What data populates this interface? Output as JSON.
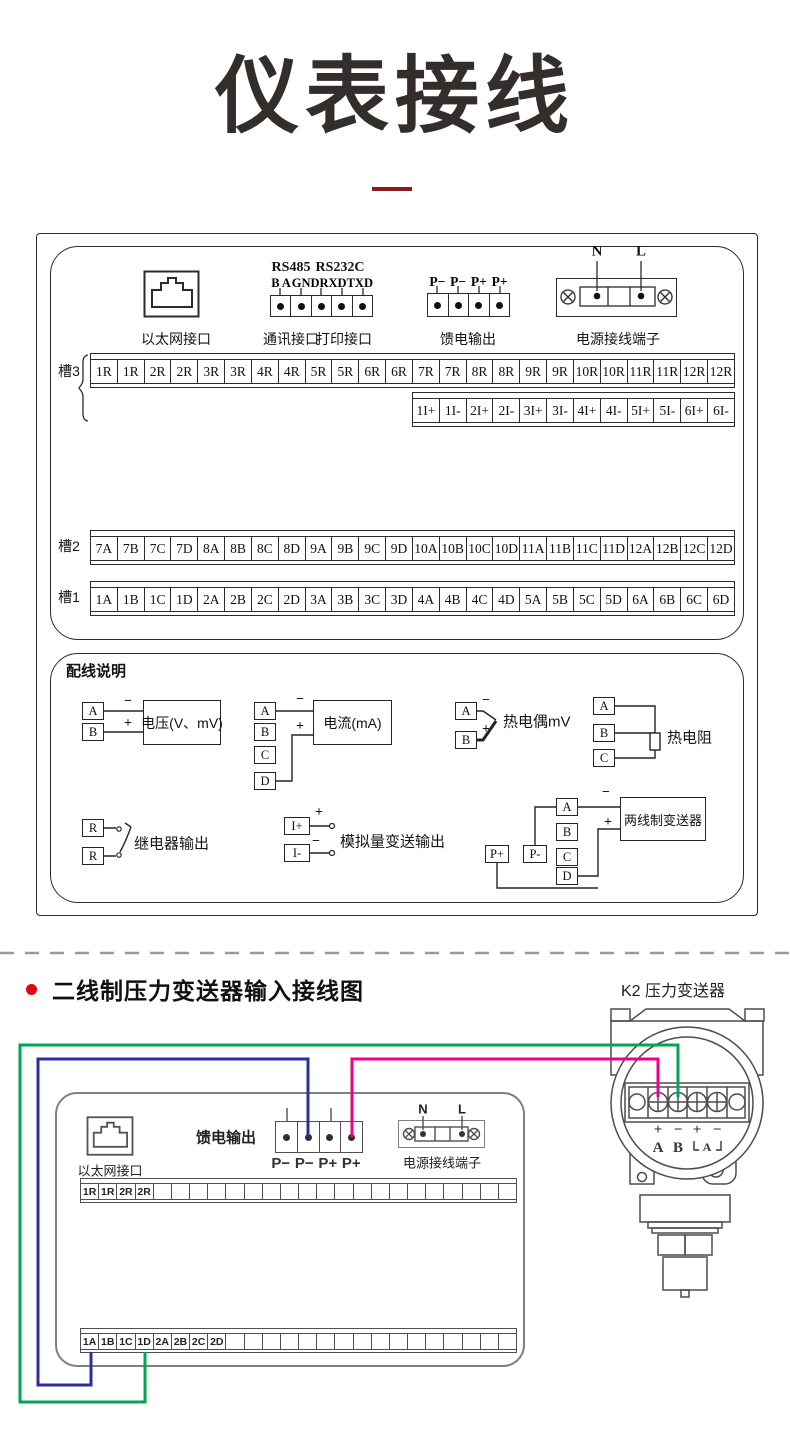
{
  "title": "仪表接线",
  "upper": {
    "ethernet_label": "以太网接口",
    "comm": {
      "rs485": "RS485",
      "rs232c": "RS232C",
      "pins": [
        "B",
        "A",
        "GND",
        "RXD",
        "TXD"
      ],
      "comm_label": "通讯接口",
      "print_label": "打印接口"
    },
    "feed": {
      "pins": [
        "P−",
        "P−",
        "P+",
        "P+"
      ],
      "label": "馈电输出"
    },
    "power": {
      "n": "N",
      "l": "L",
      "label": "电源接线端子"
    },
    "slot3_label": "槽3",
    "slot2_label": "槽2",
    "slot1_label": "槽1",
    "row_r": [
      "1R",
      "1R",
      "2R",
      "2R",
      "3R",
      "3R",
      "4R",
      "4R",
      "5R",
      "5R",
      "6R",
      "6R",
      "7R",
      "7R",
      "8R",
      "8R",
      "9R",
      "9R",
      "10R",
      "10R",
      "11R",
      "11R",
      "12R",
      "12R"
    ],
    "row_i": [
      "1I+",
      "1I-",
      "2I+",
      "2I-",
      "3I+",
      "3I-",
      "4I+",
      "4I-",
      "5I+",
      "5I-",
      "6I+",
      "6I-"
    ],
    "row_slot2": [
      "7A",
      "7B",
      "7C",
      "7D",
      "8A",
      "8B",
      "8C",
      "8D",
      "9A",
      "9B",
      "9C",
      "9D",
      "10A",
      "10B",
      "10C",
      "10D",
      "11A",
      "11B",
      "11C",
      "11D",
      "12A",
      "12B",
      "12C",
      "12D"
    ],
    "row_slot1": [
      "1A",
      "1B",
      "1C",
      "1D",
      "2A",
      "2B",
      "2C",
      "2D",
      "3A",
      "3B",
      "3C",
      "3D",
      "4A",
      "4B",
      "4C",
      "4D",
      "5A",
      "5B",
      "5C",
      "5D",
      "6A",
      "6B",
      "6C",
      "6D"
    ]
  },
  "wiring": {
    "title": "配线说明",
    "voltage": {
      "a": "A",
      "b": "B",
      "minus": "−",
      "plus": "+",
      "label": "电压(V、mV)"
    },
    "current": {
      "a": "A",
      "b": "B",
      "c": "C",
      "d": "D",
      "minus": "−",
      "plus": "+",
      "label": "电流(mA)"
    },
    "thermocouple": {
      "a": "A",
      "b": "B",
      "minus": "−",
      "plus": "+",
      "label": "热电偶mV"
    },
    "rtd": {
      "a": "A",
      "b": "B",
      "c": "C",
      "label": "热电阻"
    },
    "relay": {
      "r1": "R",
      "r2": "R",
      "label": "继电器输出"
    },
    "analog": {
      "ip": "I+",
      "im": "I-",
      "plus": "+",
      "minus": "−",
      "label": "模拟量变送输出"
    },
    "twowire": {
      "pp": "P+",
      "pm": "P-",
      "a": "A",
      "b": "B",
      "c": "C",
      "d": "D",
      "minus": "−",
      "plus": "+",
      "label": "两线制变送器"
    }
  },
  "bottom": {
    "heading": "二线制压力变送器输入接线图",
    "transmitter_label": "K2  压力变送器",
    "transmitter_pins": {
      "p1": "+",
      "p2": "−",
      "p3": "+",
      "p4": "−",
      "a": "A",
      "b": "B",
      "bracket_a": "A"
    },
    "recorder": {
      "ethernet_label": "以太网接口",
      "feed_label": "馈电输出",
      "feed_pins": [
        "P−",
        "P−",
        "P+",
        "P+"
      ],
      "power_n": "N",
      "power_l": "L",
      "power_label": "电源接线端子",
      "top_row": [
        "1R",
        "1R",
        "2R",
        "2R",
        "",
        "",
        "",
        "",
        "",
        "",
        "",
        "",
        "",
        "",
        "",
        "",
        "",
        "",
        "",
        "",
        "",
        "",
        "",
        ""
      ],
      "bottom_row": [
        "1A",
        "1B",
        "1C",
        "1D",
        "2A",
        "2B",
        "2C",
        "2D",
        "",
        "",
        "",
        "",
        "",
        "",
        "",
        "",
        "",
        "",
        "",
        "",
        "",
        "",
        "",
        ""
      ]
    }
  },
  "colors": {
    "wire_green": "#00a651",
    "wire_blue": "#2b2f9e",
    "wire_magenta": "#ec008c",
    "bullet_red": "#e60012",
    "title_underline": "#8a1b1b",
    "line_dark": "#2b2b2b",
    "line_gray": "#4f4f4f"
  }
}
